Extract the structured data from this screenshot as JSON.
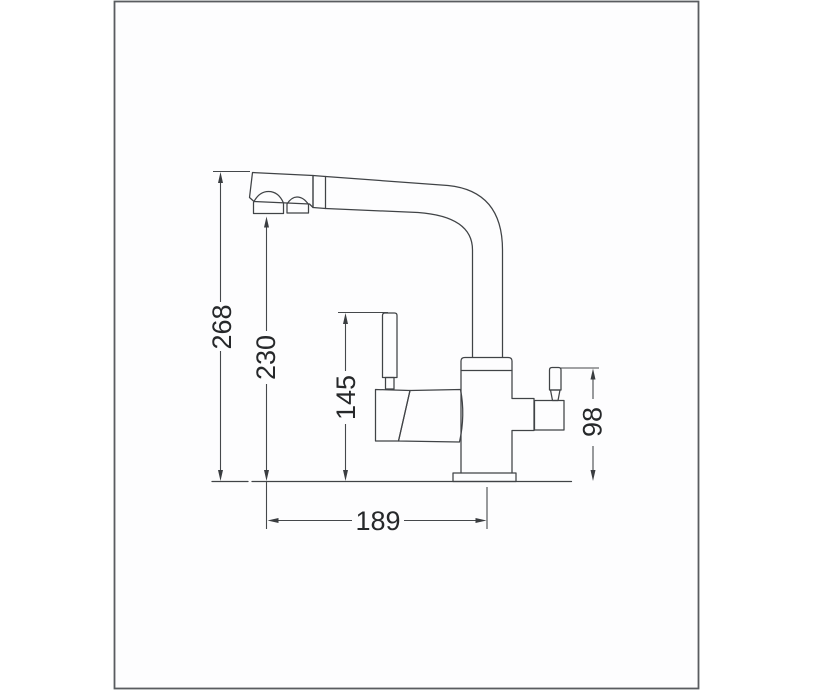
{
  "drawing": {
    "dimensions": {
      "overall_height": "268",
      "spout_outlet_height": "230",
      "handle_top_height": "145",
      "side_lever_height": "98",
      "base_depth": "189"
    },
    "colors": {
      "line": "#404346",
      "dimension_line": "#45484b",
      "text": "#26282a",
      "frame_border": "#595c60",
      "background": "#ffffff"
    }
  }
}
